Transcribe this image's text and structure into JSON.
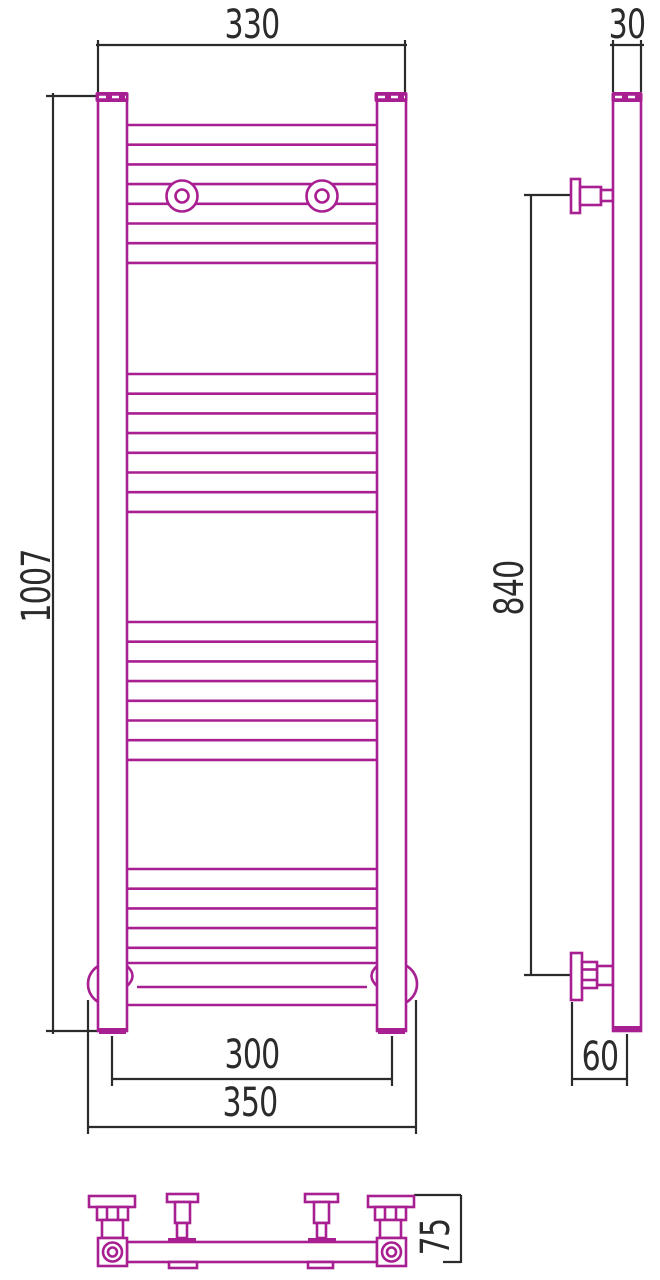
{
  "drawing": {
    "kind": "towel-radiator-dimensional-drawing",
    "units": "mm",
    "colors": {
      "product": "#a81f92",
      "dimension": "#2b2b2b",
      "background": "#ffffff"
    },
    "front_view": {
      "dim_width_top": "330",
      "dim_height": "1007",
      "dim_bottom_centers": "300",
      "dim_bottom_overall": "350",
      "rung_x1": 127,
      "rung_x2": 377,
      "rung_spacing": 19.7,
      "rung_groups": [
        {
          "count": 8,
          "start_y": 125
        },
        {
          "count": 8,
          "start_y": 374
        },
        {
          "count": 8,
          "start_y": 622
        },
        {
          "count": 5,
          "start_y": 869
        }
      ]
    },
    "side_view": {
      "dim_depth": "30",
      "dim_bracket_span": "840",
      "dim_wall_offset": "60"
    },
    "bottom_view": {
      "dim_mount_depth": "75"
    }
  }
}
